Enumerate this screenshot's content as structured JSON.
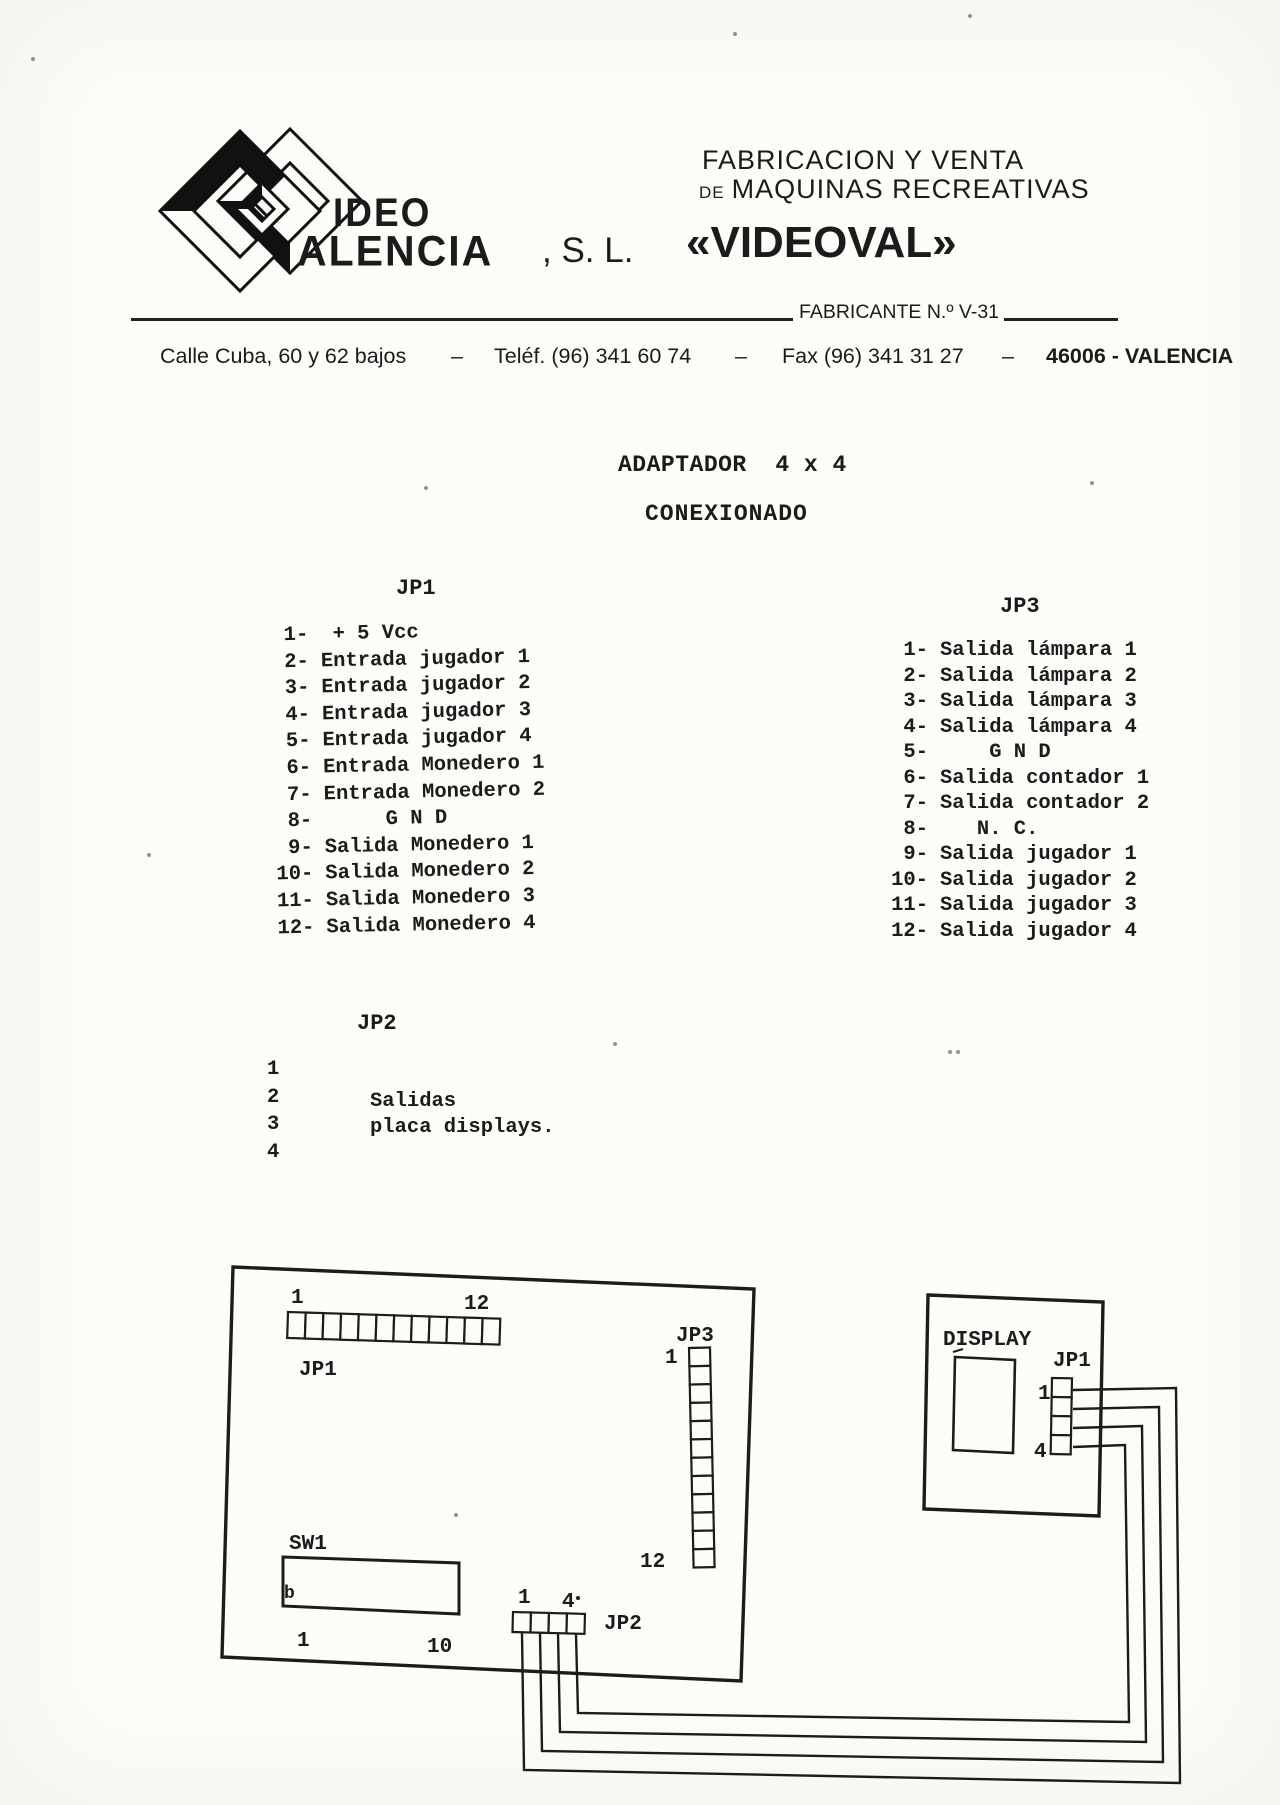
{
  "colors": {
    "paper": "#fcfcf9",
    "ink": "#1b1b1b"
  },
  "header": {
    "logo_word1": "IDEO",
    "logo_word2": "ALENCIA",
    "company_suffix": ", S. L.",
    "brand": "«VIDEOVAL»",
    "tagline1": "FABRICACION Y VENTA",
    "tagline2_small": "DE",
    "tagline2": "MAQUINAS RECREATIVAS",
    "fabricante": "FABRICANTE N.º V-31",
    "address": "Calle Cuba, 60 y 62 bajos",
    "sep": "–",
    "phone": "Teléf. (96) 341 60 74",
    "fax": "Fax (96) 341 31 27",
    "city": "46006 - VALENCIA"
  },
  "title": {
    "line1": "ADAPTADOR  4 x 4",
    "line2": "CONEXIONADO"
  },
  "jp1": {
    "heading": "JP1",
    "pins": [
      {
        "n": "1-",
        "label": " + 5 Vcc"
      },
      {
        "n": "2-",
        "label": "Entrada jugador 1"
      },
      {
        "n": "3-",
        "label": "Entrada jugador 2"
      },
      {
        "n": "4-",
        "label": "Entrada jugador 3"
      },
      {
        "n": "5-",
        "label": "Entrada jugador 4"
      },
      {
        "n": "6-",
        "label": "Entrada Monedero 1"
      },
      {
        "n": "7-",
        "label": "Entrada Monedero 2"
      },
      {
        "n": "8-",
        "label": "     G N D"
      },
      {
        "n": "9-",
        "label": "Salida Monedero 1"
      },
      {
        "n": "10-",
        "label": "Salida Monedero 2"
      },
      {
        "n": "11-",
        "label": "Salida Monedero 3"
      },
      {
        "n": "12-",
        "label": "Salida Monedero 4"
      }
    ]
  },
  "jp3": {
    "heading": "JP3",
    "pins": [
      {
        "n": "1-",
        "label": "Salida lámpara 1"
      },
      {
        "n": "2-",
        "label": "Salida lámpara 2"
      },
      {
        "n": "3-",
        "label": "Salida lámpara 3"
      },
      {
        "n": "4-",
        "label": "Salida lámpara 4"
      },
      {
        "n": "5-",
        "label": "    G N D"
      },
      {
        "n": "6-",
        "label": "Salida contador 1"
      },
      {
        "n": "7-",
        "label": "Salida contador 2"
      },
      {
        "n": "8-",
        "label": "   N. C."
      },
      {
        "n": "9-",
        "label": "Salida jugador 1"
      },
      {
        "n": "10-",
        "label": "Salida jugador 2"
      },
      {
        "n": "11-",
        "label": "Salida jugador 3"
      },
      {
        "n": "12-",
        "label": "Salida jugador 4"
      }
    ]
  },
  "jp2": {
    "heading": "JP2",
    "numbers": [
      "1",
      "2",
      "3",
      "4"
    ],
    "note1": "Salidas",
    "note2": "placa displays."
  },
  "diagram": {
    "main_board": {
      "jp1_label": "JP1",
      "jp1_first": "1",
      "jp1_last": "12",
      "jp3_label": "JP3",
      "jp3_first": "1",
      "jp3_last": "12",
      "sw1_label": "SW1",
      "sw1_mark": "b",
      "sw1_first": "1",
      "sw1_last": "10",
      "jp2_label": "JP2",
      "jp2_first": "1",
      "jp2_last": "4"
    },
    "display_board": {
      "label": "DISPLAY",
      "jp1_label": "JP1",
      "first": "1",
      "last": "4"
    }
  }
}
